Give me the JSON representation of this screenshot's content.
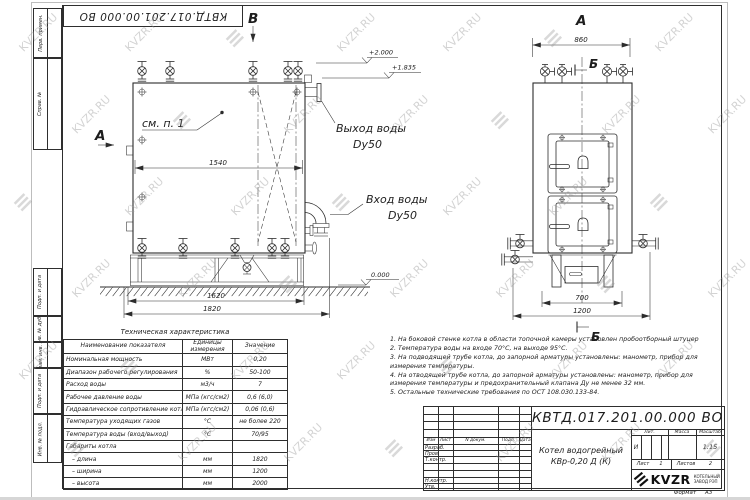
{
  "stamp": {
    "doc_number_rotated": "КВТД.017.201.00.000 ВО"
  },
  "margin_labels": [
    "Перв. примен.",
    "Справ. №",
    "Подп. и дата",
    "Инв. № дубл.",
    "Взам. инв. №",
    "Подп. и дата",
    "Инв. № подл."
  ],
  "front_view": {
    "view_letter_a": "А",
    "view_letter_b": "В",
    "see_note": "см. п. 1",
    "outlet_name": "Выход воды",
    "outlet_size": "Dy50",
    "inlet_name": "Вход воды",
    "inlet_size": "Dy50",
    "dims": {
      "inner_width": "1540",
      "frame_width": "1620",
      "overall_width": "1820"
    },
    "levels": {
      "top": "+2.000",
      "body": "+1.835",
      "ground": "0.000"
    }
  },
  "side_view": {
    "view_letter": "А",
    "section_letter_top": "Б",
    "section_letter_bottom": "Б",
    "dims": {
      "top_width": "860",
      "support_width": "700",
      "base_width": "1200"
    }
  },
  "tech_table": {
    "title": "Техническая характеристика",
    "headers": [
      "Наименование показателя",
      "Единицы измерения",
      "Значение"
    ],
    "rows": [
      [
        "Номинальная мощность",
        "МВт",
        "0,20"
      ],
      [
        "Диапазон рабочего регулирования",
        "%",
        "50-100"
      ],
      [
        "Расход воды",
        "м3/ч",
        "7"
      ],
      [
        "Рабочее давление воды",
        "МПа (кгс/см2)",
        "0,6 (6,0)"
      ],
      [
        "Гидравлическое сопротивление котла",
        "МПа (кгс/см2)",
        "0,06 (0,6)"
      ],
      [
        "Температура уходящих газов",
        "°С",
        "не более 220"
      ],
      [
        "Температура воды (вход/выход)",
        "°С",
        "70/95"
      ],
      [
        "Габариты котла",
        "",
        ""
      ],
      [
        "– длина",
        "мм",
        "1820"
      ],
      [
        "– ширина",
        "мм",
        "1200"
      ],
      [
        "– высота",
        "мм",
        "2000"
      ]
    ]
  },
  "notes": [
    "1. На боковой стенке котла в области топочной камеры установлен пробоотборный штуцер",
    "2. Температура воды на входе 70°С, на выходе 95°С.",
    "3. На подводящей трубе котла, до запорной арматуры установлены: манометр, прибор для измерения температуры.",
    "4. На отводящей трубе котла, до запорной арматуры установлены: манометр, прибор для измерения температуры и предохранительный клапана Ду не менее 32 мм.",
    "5. Остальные технические требования по ОСТ 108.030.133-84."
  ],
  "title_block": {
    "doc_number": "КВТД.017.201.00.000  ВО",
    "name_line1": "Котел водогрейный",
    "name_line2": "КВр-0,20  Д  (К)",
    "cols": {
      "izm": "Изм",
      "list": "Лист",
      "ndoc": "N докум.",
      "podp": "Подп.",
      "data": "Дата"
    },
    "rows": {
      "razrab": "Разраб.",
      "prov": "Пров.",
      "tkontr": "Т.контр.",
      "nkontr": "Н.контр.",
      "utv": "Утв."
    },
    "lit_label": "Лит.",
    "lit_value": "И",
    "massa_label": "Масса",
    "scale_label": "Масштаб",
    "scale_value": "1:15",
    "sheet_label": "Лист",
    "sheet_value": "1",
    "sheets_label": "Листов",
    "sheets_value": "2",
    "logo": {
      "name": "KVZR",
      "glyph": "≡",
      "sub1": "КОТЕЛЬНЫЙ",
      "sub2": "ЗАВОД РЭП"
    },
    "format_label": "Формат",
    "format_value": "А3"
  },
  "watermark": {
    "text": "KVZR.RU",
    "glyph": "≡"
  }
}
